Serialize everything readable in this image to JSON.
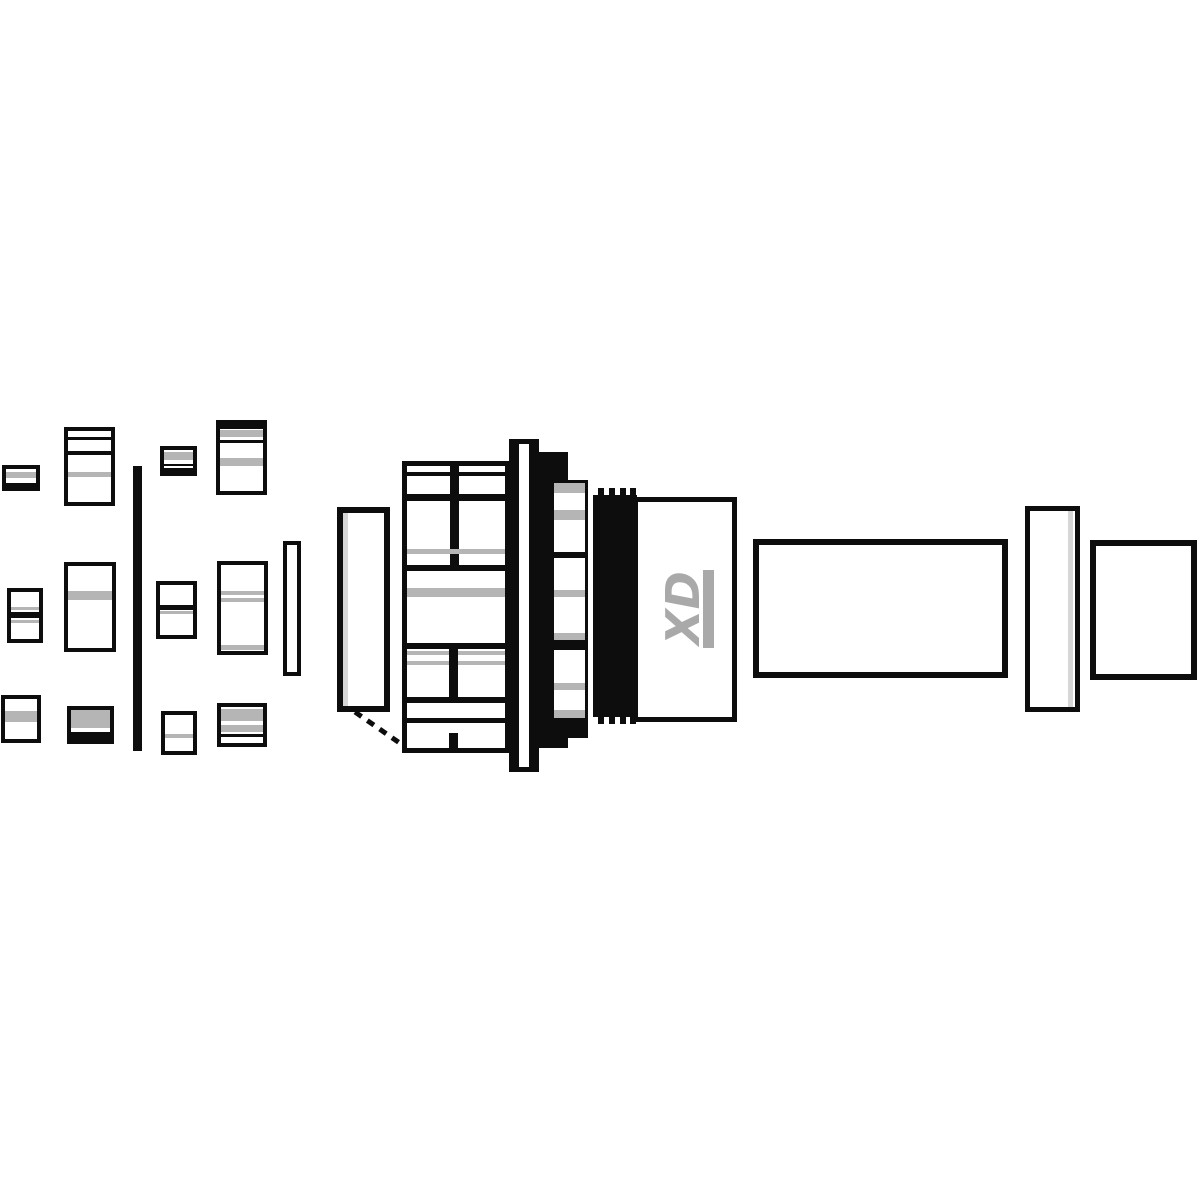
{
  "diagram": {
    "logo_text": "XD",
    "canvas": {
      "width": 1200,
      "height": 1200,
      "background": "#ffffff"
    },
    "colors": {
      "white": "#ffffff",
      "ink": "#0d0d0d",
      "gray": "#b5b5b5",
      "lightgray": "#d6d6d6",
      "logo": "#a9a9a9"
    },
    "parts": [
      {
        "name": "pawl-piece-row1-col1",
        "shapes": [
          {
            "t": "r",
            "x": 2,
            "y": 465,
            "w": 38,
            "h": 26,
            "c": "ink"
          },
          {
            "t": "r",
            "x": 6,
            "y": 469,
            "w": 30,
            "h": 14,
            "c": "white"
          },
          {
            "t": "r",
            "x": 6,
            "y": 472,
            "w": 30,
            "h": 6,
            "c": "gray"
          }
        ]
      },
      {
        "name": "pawl-piece-row1-col2",
        "shapes": [
          {
            "t": "r",
            "x": 64,
            "y": 427,
            "w": 51,
            "h": 79,
            "c": "ink"
          },
          {
            "t": "r",
            "x": 68,
            "y": 431,
            "w": 43,
            "h": 71,
            "c": "white"
          },
          {
            "t": "r",
            "x": 68,
            "y": 437,
            "w": 43,
            "h": 3,
            "c": "ink"
          },
          {
            "t": "r",
            "x": 68,
            "y": 451,
            "w": 43,
            "h": 4,
            "c": "ink"
          },
          {
            "t": "r",
            "x": 68,
            "y": 472,
            "w": 43,
            "h": 5,
            "c": "gray"
          }
        ]
      },
      {
        "name": "pawl-piece-row1-col3",
        "shapes": [
          {
            "t": "r",
            "x": 160,
            "y": 446,
            "w": 37,
            "h": 30,
            "c": "ink"
          },
          {
            "t": "r",
            "x": 164,
            "y": 450,
            "w": 29,
            "h": 18,
            "c": "white"
          },
          {
            "t": "r",
            "x": 164,
            "y": 452,
            "w": 29,
            "h": 8,
            "c": "gray"
          },
          {
            "t": "r",
            "x": 164,
            "y": 464,
            "w": 29,
            "h": 2,
            "c": "ink"
          }
        ]
      },
      {
        "name": "pawl-piece-row1-col4",
        "shapes": [
          {
            "t": "r",
            "x": 216,
            "y": 420,
            "w": 51,
            "h": 75,
            "c": "ink"
          },
          {
            "t": "r",
            "x": 220,
            "y": 429,
            "w": 43,
            "h": 62,
            "c": "white"
          },
          {
            "t": "r",
            "x": 220,
            "y": 430,
            "w": 43,
            "h": 7,
            "c": "gray"
          },
          {
            "t": "r",
            "x": 220,
            "y": 440,
            "w": 43,
            "h": 3,
            "c": "ink"
          },
          {
            "t": "r",
            "x": 220,
            "y": 458,
            "w": 43,
            "h": 8,
            "c": "gray"
          }
        ]
      },
      {
        "name": "pawl-piece-row2-col1",
        "shapes": [
          {
            "t": "r",
            "x": 7,
            "y": 588,
            "w": 36,
            "h": 55,
            "c": "ink"
          },
          {
            "t": "r",
            "x": 11,
            "y": 592,
            "w": 28,
            "h": 47,
            "c": "white"
          },
          {
            "t": "r",
            "x": 11,
            "y": 607,
            "w": 28,
            "h": 3,
            "c": "gray"
          },
          {
            "t": "r",
            "x": 11,
            "y": 612,
            "w": 28,
            "h": 6,
            "c": "ink"
          },
          {
            "t": "r",
            "x": 11,
            "y": 620,
            "w": 28,
            "h": 3,
            "c": "gray"
          }
        ]
      },
      {
        "name": "pawl-piece-row2-col2",
        "shapes": [
          {
            "t": "r",
            "x": 64,
            "y": 562,
            "w": 52,
            "h": 90,
            "c": "ink"
          },
          {
            "t": "r",
            "x": 68,
            "y": 566,
            "w": 44,
            "h": 82,
            "c": "white"
          },
          {
            "t": "r",
            "x": 68,
            "y": 591,
            "w": 44,
            "h": 9,
            "c": "gray"
          }
        ]
      },
      {
        "name": "pawl-piece-row2-col3",
        "shapes": [
          {
            "t": "r",
            "x": 156,
            "y": 581,
            "w": 41,
            "h": 58,
            "c": "ink"
          },
          {
            "t": "r",
            "x": 160,
            "y": 585,
            "w": 33,
            "h": 50,
            "c": "white"
          },
          {
            "t": "r",
            "x": 160,
            "y": 605,
            "w": 33,
            "h": 5,
            "c": "ink"
          },
          {
            "t": "r",
            "x": 160,
            "y": 611,
            "w": 33,
            "h": 3,
            "c": "gray"
          }
        ]
      },
      {
        "name": "pawl-piece-row2-col4",
        "shapes": [
          {
            "t": "r",
            "x": 217,
            "y": 561,
            "w": 51,
            "h": 94,
            "c": "ink"
          },
          {
            "t": "r",
            "x": 221,
            "y": 565,
            "w": 43,
            "h": 86,
            "c": "white"
          },
          {
            "t": "r",
            "x": 221,
            "y": 591,
            "w": 43,
            "h": 4,
            "c": "gray"
          },
          {
            "t": "r",
            "x": 221,
            "y": 598,
            "w": 43,
            "h": 4,
            "c": "gray"
          },
          {
            "t": "r",
            "x": 221,
            "y": 645,
            "w": 43,
            "h": 5,
            "c": "gray"
          }
        ]
      },
      {
        "name": "thin-washer-plate",
        "shapes": [
          {
            "t": "r",
            "x": 283,
            "y": 541,
            "w": 18,
            "h": 135,
            "c": "ink"
          },
          {
            "t": "r",
            "x": 287,
            "y": 545,
            "w": 10,
            "h": 127,
            "c": "white"
          }
        ]
      },
      {
        "name": "pawl-piece-row3-col1",
        "shapes": [
          {
            "t": "r",
            "x": 1,
            "y": 695,
            "w": 40,
            "h": 48,
            "c": "ink"
          },
          {
            "t": "r",
            "x": 5,
            "y": 699,
            "w": 32,
            "h": 40,
            "c": "white"
          },
          {
            "t": "r",
            "x": 5,
            "y": 711,
            "w": 32,
            "h": 11,
            "c": "gray"
          }
        ]
      },
      {
        "name": "pawl-piece-row3-col2",
        "shapes": [
          {
            "t": "r",
            "x": 67,
            "y": 706,
            "w": 47,
            "h": 38,
            "c": "ink"
          },
          {
            "t": "r",
            "x": 71,
            "y": 710,
            "w": 39,
            "h": 22,
            "c": "white"
          },
          {
            "t": "r",
            "x": 71,
            "y": 710,
            "w": 39,
            "h": 18,
            "c": "gray"
          }
        ]
      },
      {
        "name": "pawl-piece-row3-col3",
        "shapes": [
          {
            "t": "r",
            "x": 161,
            "y": 711,
            "w": 36,
            "h": 44,
            "c": "ink"
          },
          {
            "t": "r",
            "x": 165,
            "y": 715,
            "w": 28,
            "h": 36,
            "c": "white"
          },
          {
            "t": "r",
            "x": 165,
            "y": 734,
            "w": 28,
            "h": 4,
            "c": "gray"
          }
        ]
      },
      {
        "name": "pawl-piece-row3-col4",
        "shapes": [
          {
            "t": "r",
            "x": 217,
            "y": 703,
            "w": 50,
            "h": 44,
            "c": "ink"
          },
          {
            "t": "r",
            "x": 221,
            "y": 707,
            "w": 42,
            "h": 36,
            "c": "white"
          },
          {
            "t": "r",
            "x": 221,
            "y": 709,
            "w": 42,
            "h": 12,
            "c": "gray"
          },
          {
            "t": "r",
            "x": 221,
            "y": 725,
            "w": 42,
            "h": 7,
            "c": "gray"
          },
          {
            "t": "r",
            "x": 221,
            "y": 734,
            "w": 42,
            "h": 3,
            "c": "ink"
          }
        ]
      },
      {
        "name": "leaf-spring-bar",
        "shapes": [
          {
            "t": "r",
            "x": 133,
            "y": 466,
            "w": 9,
            "h": 285,
            "c": "ink"
          }
        ]
      },
      {
        "name": "seal-washer-tall",
        "shapes": [
          {
            "t": "r",
            "x": 337,
            "y": 507,
            "w": 53,
            "h": 205,
            "c": "ink"
          },
          {
            "t": "r",
            "x": 343,
            "y": 513,
            "w": 41,
            "h": 193,
            "c": "white"
          },
          {
            "t": "r",
            "x": 343,
            "y": 513,
            "w": 5,
            "h": 193,
            "c": "lightgray"
          }
        ]
      },
      {
        "name": "thread-guide-dashed-line",
        "shapes": [
          {
            "t": "l",
            "x1": 355,
            "y1": 712,
            "x2": 404,
            "y2": 746,
            "c": "ink",
            "sw": 5,
            "dash": "8 7"
          }
        ]
      },
      {
        "name": "ratchet-housing",
        "shapes": [
          {
            "t": "r",
            "x": 402,
            "y": 461,
            "w": 108,
            "h": 292,
            "c": "ink"
          },
          {
            "t": "r",
            "x": 407,
            "y": 466,
            "w": 98,
            "h": 282,
            "c": "white"
          },
          {
            "t": "r",
            "x": 407,
            "y": 472,
            "w": 98,
            "h": 4,
            "c": "ink"
          },
          {
            "t": "r",
            "x": 407,
            "y": 494,
            "w": 98,
            "h": 7,
            "c": "ink"
          },
          {
            "t": "r",
            "x": 450,
            "y": 466,
            "w": 9,
            "h": 104,
            "c": "ink"
          },
          {
            "t": "r",
            "x": 407,
            "y": 549,
            "w": 98,
            "h": 5,
            "c": "gray"
          },
          {
            "t": "r",
            "x": 407,
            "y": 565,
            "w": 98,
            "h": 6,
            "c": "ink"
          },
          {
            "t": "r",
            "x": 407,
            "y": 588,
            "w": 98,
            "h": 9,
            "c": "gray"
          },
          {
            "t": "r",
            "x": 407,
            "y": 643,
            "w": 98,
            "h": 6,
            "c": "ink"
          },
          {
            "t": "r",
            "x": 407,
            "y": 651,
            "w": 98,
            "h": 4,
            "c": "gray"
          },
          {
            "t": "r",
            "x": 407,
            "y": 661,
            "w": 98,
            "h": 4,
            "c": "gray"
          },
          {
            "t": "r",
            "x": 449,
            "y": 643,
            "w": 9,
            "h": 60,
            "c": "ink"
          },
          {
            "t": "r",
            "x": 407,
            "y": 697,
            "w": 98,
            "h": 6,
            "c": "ink"
          },
          {
            "t": "r",
            "x": 407,
            "y": 718,
            "w": 98,
            "h": 5,
            "c": "ink"
          },
          {
            "t": "r",
            "x": 449,
            "y": 733,
            "w": 9,
            "h": 15,
            "c": "ink"
          }
        ]
      },
      {
        "name": "flange-disc",
        "shapes": [
          {
            "t": "r",
            "x": 509,
            "y": 439,
            "w": 30,
            "h": 333,
            "c": "ink"
          },
          {
            "t": "r",
            "x": 519,
            "y": 444,
            "w": 10,
            "h": 323,
            "c": "white"
          }
        ]
      },
      {
        "name": "spline-ratchet-ring",
        "shapes": [
          {
            "t": "r",
            "x": 539,
            "y": 462,
            "w": 12,
            "h": 286,
            "c": "ink"
          },
          {
            "t": "r",
            "x": 539,
            "y": 452,
            "w": 29,
            "h": 45,
            "c": "ink"
          },
          {
            "t": "r",
            "x": 539,
            "y": 718,
            "w": 29,
            "h": 30,
            "c": "ink"
          },
          {
            "t": "r",
            "x": 551,
            "y": 480,
            "w": 37,
            "h": 258,
            "c": "ink"
          },
          {
            "t": "r",
            "x": 554,
            "y": 483,
            "w": 31,
            "h": 10,
            "c": "gray"
          },
          {
            "t": "r",
            "x": 554,
            "y": 493,
            "w": 31,
            "h": 17,
            "c": "white"
          },
          {
            "t": "r",
            "x": 554,
            "y": 510,
            "w": 31,
            "h": 10,
            "c": "gray"
          },
          {
            "t": "r",
            "x": 554,
            "y": 520,
            "w": 31,
            "h": 32,
            "c": "white"
          },
          {
            "t": "r",
            "x": 554,
            "y": 558,
            "w": 31,
            "h": 32,
            "c": "white"
          },
          {
            "t": "r",
            "x": 554,
            "y": 590,
            "w": 31,
            "h": 7,
            "c": "gray"
          },
          {
            "t": "r",
            "x": 554,
            "y": 597,
            "w": 31,
            "h": 36,
            "c": "white"
          },
          {
            "t": "r",
            "x": 554,
            "y": 633,
            "w": 31,
            "h": 7,
            "c": "gray"
          },
          {
            "t": "r",
            "x": 554,
            "y": 650,
            "w": 31,
            "h": 33,
            "c": "white"
          },
          {
            "t": "r",
            "x": 554,
            "y": 683,
            "w": 31,
            "h": 7,
            "c": "gray"
          },
          {
            "t": "r",
            "x": 554,
            "y": 690,
            "w": 31,
            "h": 20,
            "c": "white"
          },
          {
            "t": "r",
            "x": 554,
            "y": 710,
            "w": 31,
            "h": 8,
            "c": "gray"
          }
        ]
      },
      {
        "name": "rubber-seal-ring",
        "shapes": [
          {
            "t": "r",
            "x": 593,
            "y": 495,
            "w": 44,
            "h": 222,
            "c": "ink"
          },
          {
            "t": "r",
            "x": 598,
            "y": 488,
            "w": 6,
            "h": 8,
            "c": "ink"
          },
          {
            "t": "r",
            "x": 609,
            "y": 488,
            "w": 6,
            "h": 8,
            "c": "ink"
          },
          {
            "t": "r",
            "x": 620,
            "y": 488,
            "w": 6,
            "h": 8,
            "c": "ink"
          },
          {
            "t": "r",
            "x": 630,
            "y": 488,
            "w": 6,
            "h": 8,
            "c": "ink"
          },
          {
            "t": "r",
            "x": 598,
            "y": 716,
            "w": 6,
            "h": 8,
            "c": "ink"
          },
          {
            "t": "r",
            "x": 609,
            "y": 716,
            "w": 6,
            "h": 8,
            "c": "ink"
          },
          {
            "t": "r",
            "x": 620,
            "y": 716,
            "w": 6,
            "h": 8,
            "c": "ink"
          },
          {
            "t": "r",
            "x": 630,
            "y": 716,
            "w": 6,
            "h": 8,
            "c": "ink"
          }
        ]
      },
      {
        "name": "xd-driver-body",
        "shapes": [
          {
            "t": "r",
            "x": 633,
            "y": 497,
            "w": 104,
            "h": 225,
            "c": "ink"
          },
          {
            "t": "r",
            "x": 638,
            "y": 502,
            "w": 94,
            "h": 215,
            "c": "white"
          },
          {
            "t": "r",
            "x": 703,
            "y": 570,
            "w": 11,
            "h": 78,
            "c": "logo"
          },
          {
            "t": "text",
            "x": 683,
            "y": 608,
            "rot": -90,
            "size": 46,
            "c": "logo",
            "bind": "diagram.logo_text",
            "name": "xd-logo-text"
          }
        ]
      },
      {
        "name": "axle-spacer-tube",
        "shapes": [
          {
            "t": "r",
            "x": 753,
            "y": 539,
            "w": 255,
            "h": 139,
            "c": "ink"
          },
          {
            "t": "r",
            "x": 759,
            "y": 545,
            "w": 243,
            "h": 127,
            "c": "white"
          }
        ]
      },
      {
        "name": "spacer-ring",
        "shapes": [
          {
            "t": "r",
            "x": 1025,
            "y": 506,
            "w": 55,
            "h": 206,
            "c": "ink"
          },
          {
            "t": "r",
            "x": 1030,
            "y": 511,
            "w": 45,
            "h": 196,
            "c": "white"
          },
          {
            "t": "r",
            "x": 1068,
            "y": 511,
            "w": 5,
            "h": 196,
            "c": "lightgray"
          }
        ]
      },
      {
        "name": "end-cap",
        "shapes": [
          {
            "t": "r",
            "x": 1090,
            "y": 540,
            "w": 107,
            "h": 140,
            "c": "ink"
          },
          {
            "t": "r",
            "x": 1096,
            "y": 546,
            "w": 95,
            "h": 128,
            "c": "white"
          }
        ]
      }
    ]
  }
}
